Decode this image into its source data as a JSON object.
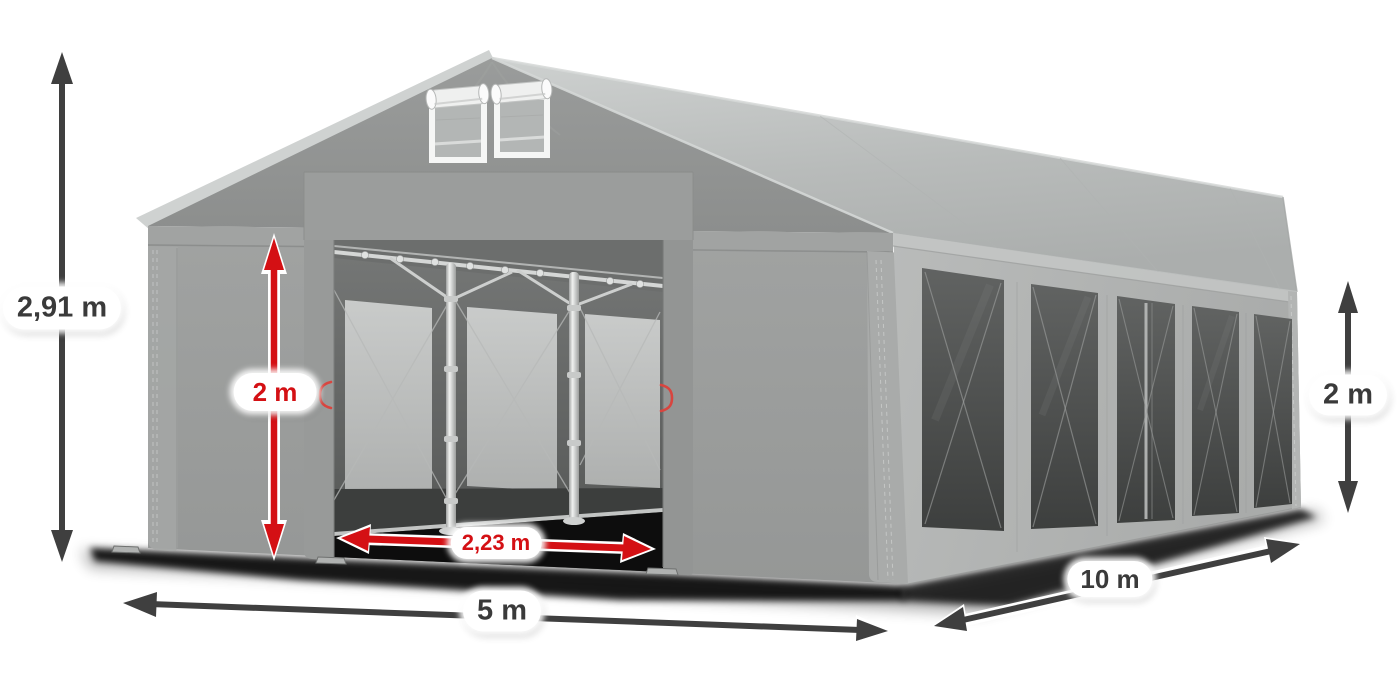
{
  "diagram": {
    "subject": "Gray PVC party tent (marquee) 5 x 10 m shown in three-quarter view with dimension arrows",
    "background_color": "#ffffff"
  },
  "annotations": {
    "total_height": {
      "text": "2,91 m",
      "style": "dark",
      "orientation": "vertical",
      "position": "left-of-tent"
    },
    "entrance_height": {
      "text": "2 m",
      "style": "red",
      "orientation": "vertical",
      "position": "front-entrance-left"
    },
    "entrance_width": {
      "text": "2,23 m",
      "style": "red",
      "orientation": "horizontal",
      "position": "front-entrance-bottom"
    },
    "front_width": {
      "text": "5 m",
      "style": "dark",
      "orientation": "horizontal",
      "position": "below-front-face"
    },
    "side_length": {
      "text": "10 m",
      "style": "dark",
      "orientation": "diagonal",
      "position": "below-right-side"
    },
    "side_wall_height": {
      "text": "2 m",
      "style": "dark",
      "orientation": "vertical",
      "position": "right-of-tent"
    }
  },
  "colors": {
    "arrow_dark": "#3f3f3f",
    "arrow_red": "#d41014",
    "label_bg": "#ffffff",
    "label_text_dark": "#3a3a3a",
    "label_text_red": "#d41014",
    "page_bg": "#ffffff",
    "tent_wall_gray": "#9c9e9d",
    "tent_roof_gray": "#bcbfbe",
    "tent_window_dark": "#4a4c4b"
  }
}
